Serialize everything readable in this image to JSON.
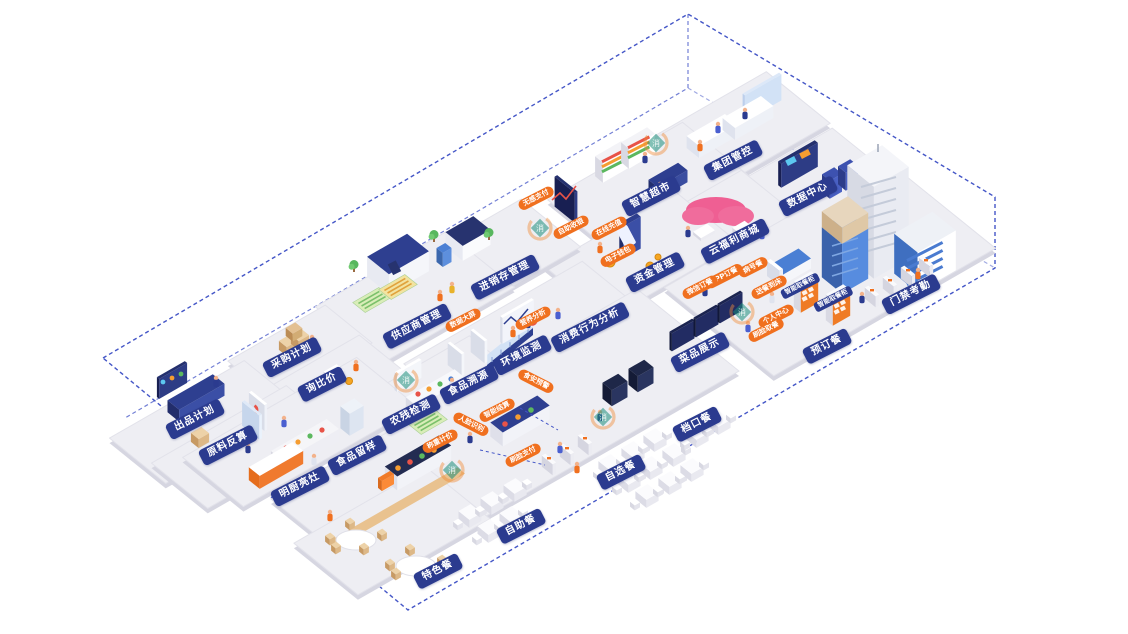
{
  "colors": {
    "navy": "#2b3b8f",
    "orange": "#f0701f",
    "dash_blue": "#4456c7",
    "platform_gray": "#eeeef3",
    "teal": "#1b8e7a"
  },
  "watermark": {
    "glyph": "消"
  },
  "areas": {
    "blue_labels": [
      "出品计划",
      "原料反算",
      "采购计划",
      "询比价",
      "供应商管理",
      "进销存管理",
      "智慧超市",
      "集团管控",
      "数据中心",
      "云福利商城",
      "资金管理",
      "环境监测",
      "消费行为分析",
      "食品溯源",
      "农残检测",
      "食品留样",
      "明厨亮灶",
      "特色餐",
      "自助餐",
      "自选餐",
      "档口餐",
      "预订餐",
      "门禁考勤",
      "菜品展示"
    ],
    "cabinet_labels": [
      "智能取餐柜",
      "智能取餐柜"
    ],
    "orange_labels": [
      "无感支付",
      "自助收银",
      "在线充值",
      "电子钱包",
      "数据大屏",
      "营养分析",
      "食安预警",
      "智能结算",
      "称重计价",
      "人脸识别",
      "刷脸支付",
      "APP订餐",
      "微信订餐",
      "病号餐",
      "送餐到床",
      "个人中心",
      "刷脸取餐"
    ]
  }
}
